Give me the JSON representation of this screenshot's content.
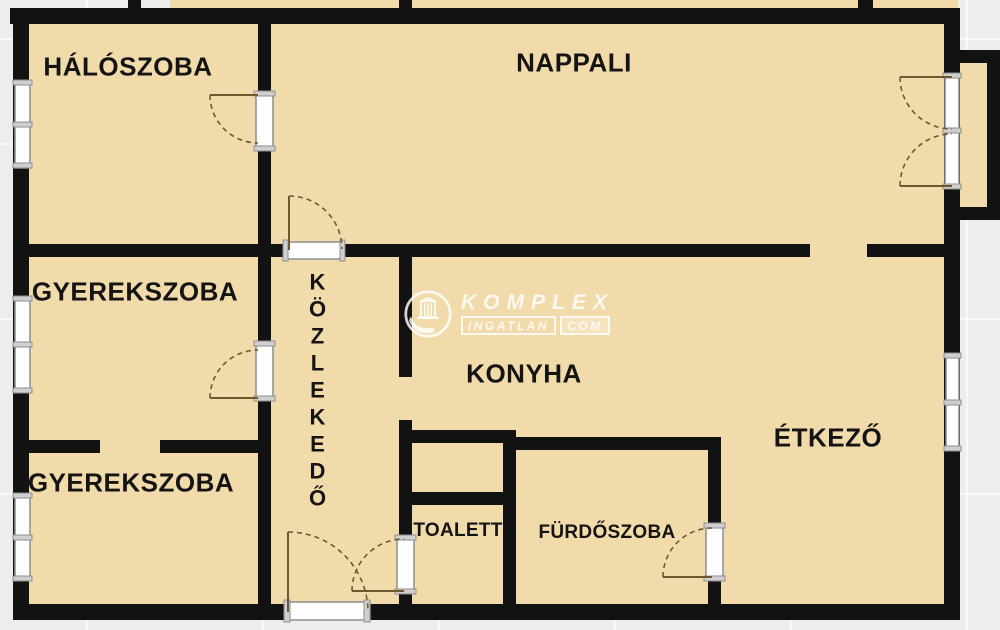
{
  "rooms": {
    "haloszoba": {
      "label": "HÁLÓSZOBA"
    },
    "nappali": {
      "label": "NAPPALI"
    },
    "gyerekszoba1": {
      "label": "GYEREKSZOBA"
    },
    "gyerekszoba2": {
      "label": "GYEREKSZOBA"
    },
    "kozlekedo": {
      "label": "KÖZLEKEDŐ"
    },
    "konyha": {
      "label": "KONYHA"
    },
    "etkezo": {
      "label": "ÉTKEZŐ"
    },
    "toalett": {
      "label": "TOALETT"
    },
    "furdoszoba": {
      "label": "FÜRDŐSZOBA"
    }
  },
  "watermark": {
    "brand": "KOMPLEX",
    "line2": "INGATLAN",
    "line3": "COM"
  },
  "colors": {
    "floor": "#f2dbaa",
    "wall": "#121212",
    "bg": "#eeedeb",
    "arc": "#6f572f",
    "label": "#141414"
  }
}
